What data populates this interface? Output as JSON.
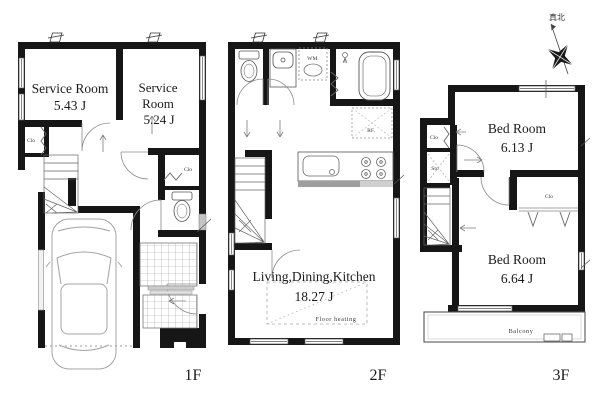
{
  "compass": {
    "north_label": "真北"
  },
  "floor1": {
    "label": "1F",
    "service_room_1": {
      "name": "Service Room",
      "size": "5.43 J"
    },
    "service_room_2": {
      "name_line1": "Service",
      "name_line2": "Room",
      "size": "5.24 J"
    },
    "closet_left": "Clo",
    "closet_right": "Clo"
  },
  "floor2": {
    "label": "2F",
    "ldk": {
      "name": "Living,Dining,Kitchen",
      "size": "18.27 J"
    },
    "washing_machine": "WM.",
    "refrigerator": "RF.",
    "floor_heating": "Floor heating"
  },
  "floor3": {
    "label": "3F",
    "bedroom_1": {
      "name": "Bed Room",
      "size": "6.13 J"
    },
    "bedroom_2": {
      "name": "Bed Room",
      "size": "6.64 J"
    },
    "closet_hall": "Clo",
    "storage": "Sto",
    "closet_bedroom2": "Clo",
    "balcony": "Balcony"
  }
}
